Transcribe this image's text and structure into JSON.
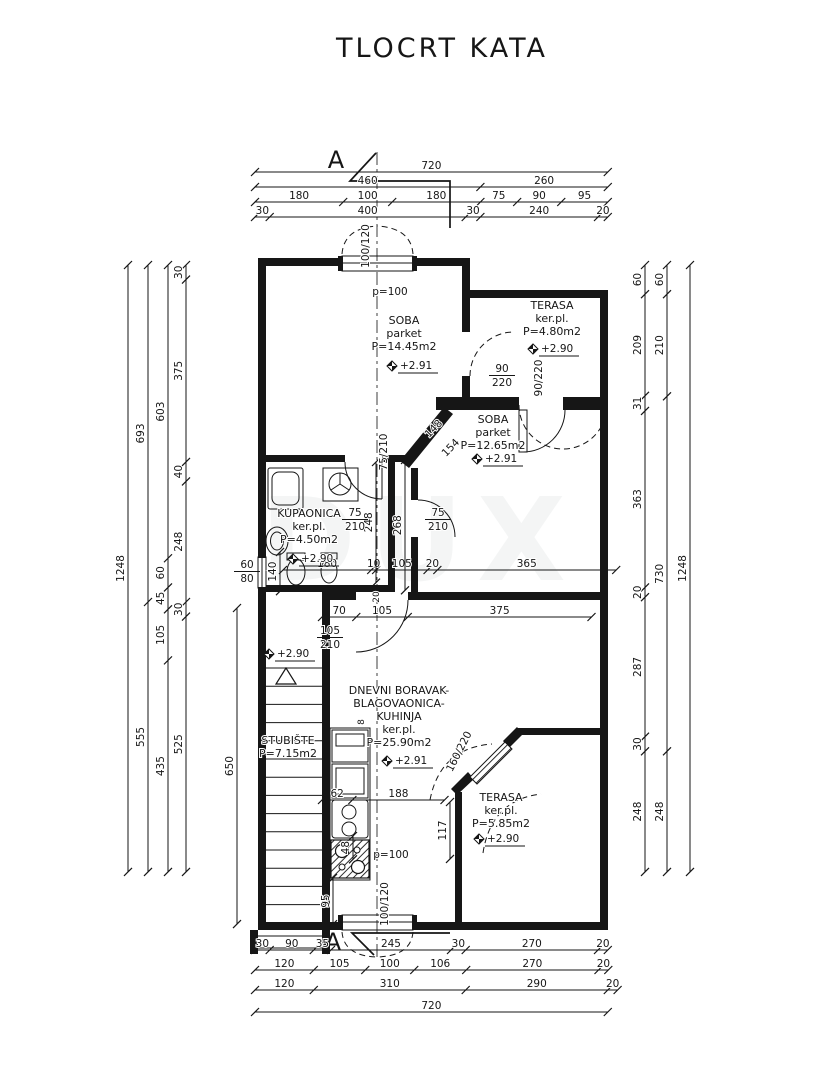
{
  "title": "TLOCRT KATA",
  "section": {
    "label": "A"
  },
  "watermark": "DUX",
  "rooms": {
    "soba1": {
      "name": "SOBA",
      "floor": "parket",
      "area": "P=14.45m2",
      "level": "+2.91"
    },
    "terasa1": {
      "name": "TERASA",
      "floor": "ker.pl.",
      "area": "P=4.80m2",
      "level": "+2.90"
    },
    "soba2": {
      "name": "SOBA",
      "floor": "parket",
      "area": "P=12.65m2",
      "level": "+2.91"
    },
    "kupaonica": {
      "name": "KUPAONICA",
      "floor": "ker.pl.",
      "area": "P=4.50m2",
      "level": "+2.90"
    },
    "stubiste": {
      "name": "STUBIŠTE",
      "area": "P=7.15m2",
      "level": "+2.90"
    },
    "dnevni": {
      "name_line1": "DNEVNI BORAVAK-",
      "name_line2": "BLAGOVAONICA-",
      "name_line3": "KUHINJA",
      "floor": "ker.pl.",
      "area": "P=25.90m2",
      "level": "+2.91"
    },
    "terasa2": {
      "name": "TERASA",
      "floor": "ker.pl.",
      "area": "P=5.85m2",
      "level": "+2.90"
    }
  },
  "openings": {
    "top_window": "100/120",
    "top_window_parapet": "p=100",
    "bottom_window": "100/120",
    "bottom_window_parapet": "p=100",
    "terasa1_door_side": "90/220",
    "terasa1_door_bottom": "90/220",
    "soba2_wall_door": "75/210",
    "kupaonica_door": "75/210",
    "soba2_door": "75/210",
    "stair_door": "105/210",
    "terasa2_door": "160/220",
    "bath_window": "60/80"
  },
  "dims": {
    "top": [
      [
        720
      ],
      [
        460,
        260
      ],
      [
        180,
        100,
        180,
        75,
        90,
        95
      ],
      [
        30,
        400,
        30,
        240,
        20
      ]
    ],
    "bottom": [
      [
        30,
        90,
        35,
        245,
        30,
        270,
        20
      ],
      [
        120,
        105,
        100,
        106,
        270,
        20
      ],
      [
        120,
        310,
        290,
        20
      ],
      [
        720
      ]
    ],
    "left": [
      [
        1248
      ],
      [
        693,
        555
      ],
      [
        603,
        60,
        45,
        105,
        435
      ],
      [
        30,
        375,
        40,
        248,
        30,
        525
      ]
    ],
    "right": [
      [
        60,
        209,
        31,
        363,
        20,
        287,
        30,
        248
      ],
      [
        60,
        210,
        730,
        248
      ],
      [
        1248
      ]
    ],
    "interior": {
      "hall_upper": [
        180,
        10,
        105,
        20,
        365
      ],
      "hall_lower": [
        70,
        105,
        375
      ],
      "kitchen": [
        62,
        188
      ],
      "stair_height": [
        650
      ],
      "corridor": [
        268
      ],
      "bath_height": [
        248
      ],
      "terrace_door": [
        117
      ],
      "counter": [
        48
      ],
      "window_offset": [
        95
      ],
      "wc_width": [
        140
      ]
    },
    "diagonal": {
      "d1": "148",
      "d2": "154"
    },
    "small": {
      "wall": "8",
      "gap": "20"
    }
  }
}
